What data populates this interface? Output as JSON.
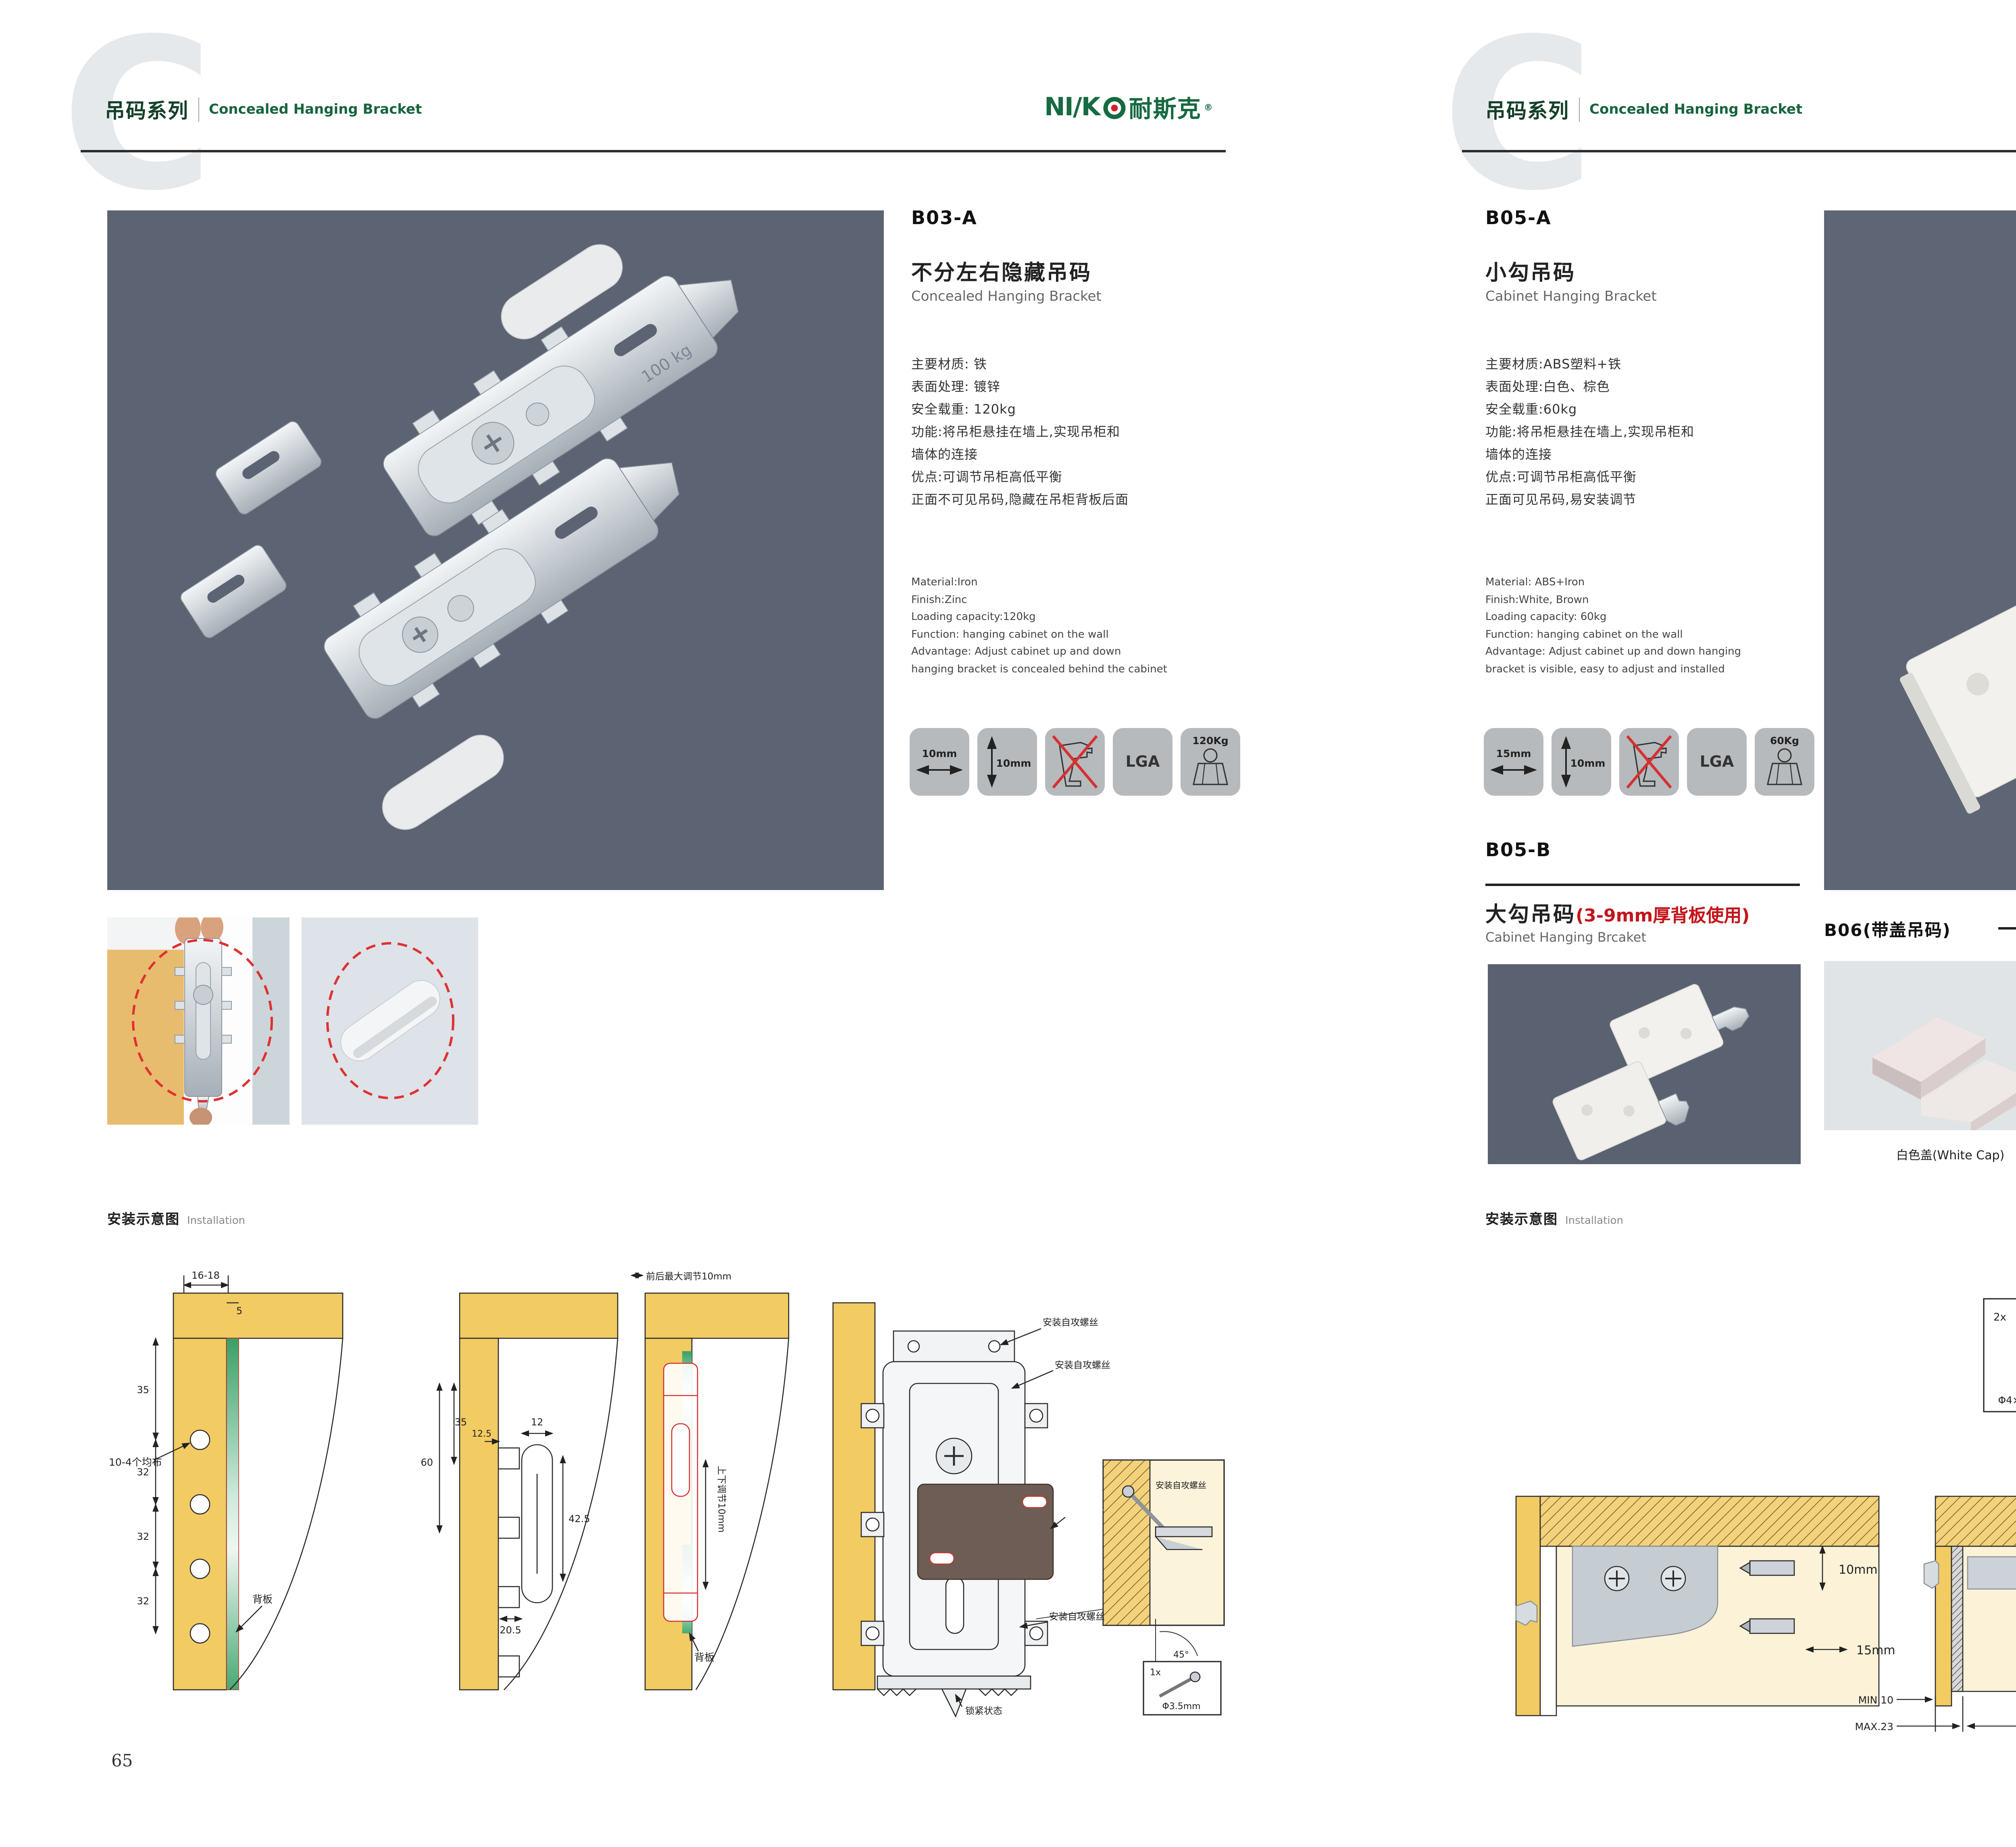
{
  "brand": {
    "logo_prefix": "NI∕K",
    "logo_cn": "耐斯克",
    "reg": "®"
  },
  "colors": {
    "accent_green": "#17643c",
    "alert_red": "#c3151c",
    "photo_slate": "#5c6372",
    "wood": "#f2cb63",
    "icon_tile": "#b6babd",
    "light_tile": "#e0e4e7"
  },
  "left_page": {
    "header": {
      "watermark": "C",
      "series_cn": "吊码系列",
      "series_en": "Concealed Hanging Bracket"
    },
    "product": {
      "code": "B03-A",
      "title_cn": "不分左右隐藏吊码",
      "title_en": "Concealed Hanging Bracket",
      "specs_cn": [
        "主要材质: 铁",
        "表面处理: 镀锌",
        "安全载重: 120kg",
        "功能:将吊柜悬挂在墙上,实现吊柜和",
        "墙体的连接",
        "优点:可调节吊柜高低平衡",
        "正面不可见吊码,隐藏在吊柜背板后面"
      ],
      "specs_en": [
        "Material:Iron",
        "Finish:Zinc",
        "Loading capacity:120kg",
        "Function: hanging cabinet on the wall",
        "Advantage: Adjust cabinet up and down",
        "hanging bracket is concealed behind the cabinet"
      ],
      "photo_note": "100 kg"
    },
    "icons": {
      "width": "10mm",
      "height": "10mm",
      "cert": "LGA",
      "load": "120Kg"
    },
    "installation": {
      "title_cn": "安装示意图",
      "title_en": "Installation",
      "d1": {
        "dims": [
          "16-18",
          "5",
          "35",
          "32",
          "32",
          "32"
        ],
        "labels": [
          "10-4个均布",
          "背板"
        ]
      },
      "d2": {
        "dims": [
          "60",
          "35",
          "12.5",
          "12",
          "42.5",
          "20.5"
        ]
      },
      "d3": {
        "labels": [
          "前后最大调节10mm",
          "上下调节10mm",
          "背板"
        ]
      },
      "d4": {
        "labels": [
          "安装自攻螺丝",
          "安装自攻螺丝",
          "专用挂片",
          "安装自攻螺丝",
          "锁紧状态"
        ],
        "detail": {
          "label": "安装自攻螺丝",
          "angle": "45°",
          "qty": "1x",
          "screw": "Φ3.5mm"
        }
      }
    },
    "page_number": "65"
  },
  "right_page": {
    "header": {
      "watermark": "C",
      "series_cn": "吊码系列",
      "series_en": "Concealed Hanging Bracket"
    },
    "product_a": {
      "code": "B05-A",
      "title_cn": "小勾吊码",
      "title_en": "Cabinet Hanging Bracket",
      "specs_cn": [
        "主要材质:ABS塑料+铁",
        "表面处理:白色、棕色",
        "安全载重:60kg",
        "功能:将吊柜悬挂在墙上,实现吊柜和",
        "墙体的连接",
        "优点:可调节吊柜高低平衡",
        "正面可见吊码,易安装调节"
      ],
      "specs_en": [
        "Material: ABS+Iron",
        "Finish:White, Brown",
        "Loading capacity: 60kg",
        "Function: hanging cabinet on the wall",
        "Advantage: Adjust cabinet up and down hanging",
        "bracket is visible, easy to adjust and installed"
      ]
    },
    "icons": {
      "width": "15mm",
      "height": "10mm",
      "cert": "LGA",
      "load": "60Kg"
    },
    "product_b": {
      "code": "B05-B",
      "title_cn": "大勾吊码",
      "title_cn_red": "(3-9mm厚背板使用)",
      "title_en": "Cabinet Hanging Brcaket"
    },
    "b06": {
      "title": "B06(带盖吊码)",
      "caps": [
        "白色盖(White Cap)",
        "灰色盖(Gray Cap)",
        "银色盖(Silver Cap)"
      ]
    },
    "installation": {
      "title_cn": "安装示意图",
      "title_en": "Installation",
      "d1": {
        "dims": [
          "10mm",
          "15mm"
        ]
      },
      "d2": {
        "qty": "2x",
        "screw": "Φ4×30mm",
        "dims": [
          "MIN.10",
          "MAX.23",
          "58"
        ]
      },
      "d3": {
        "dims": [
          "18",
          "16",
          "42",
          "RMAX4",
          "16",
          "17",
          "32"
        ]
      }
    },
    "page_number": "66"
  }
}
